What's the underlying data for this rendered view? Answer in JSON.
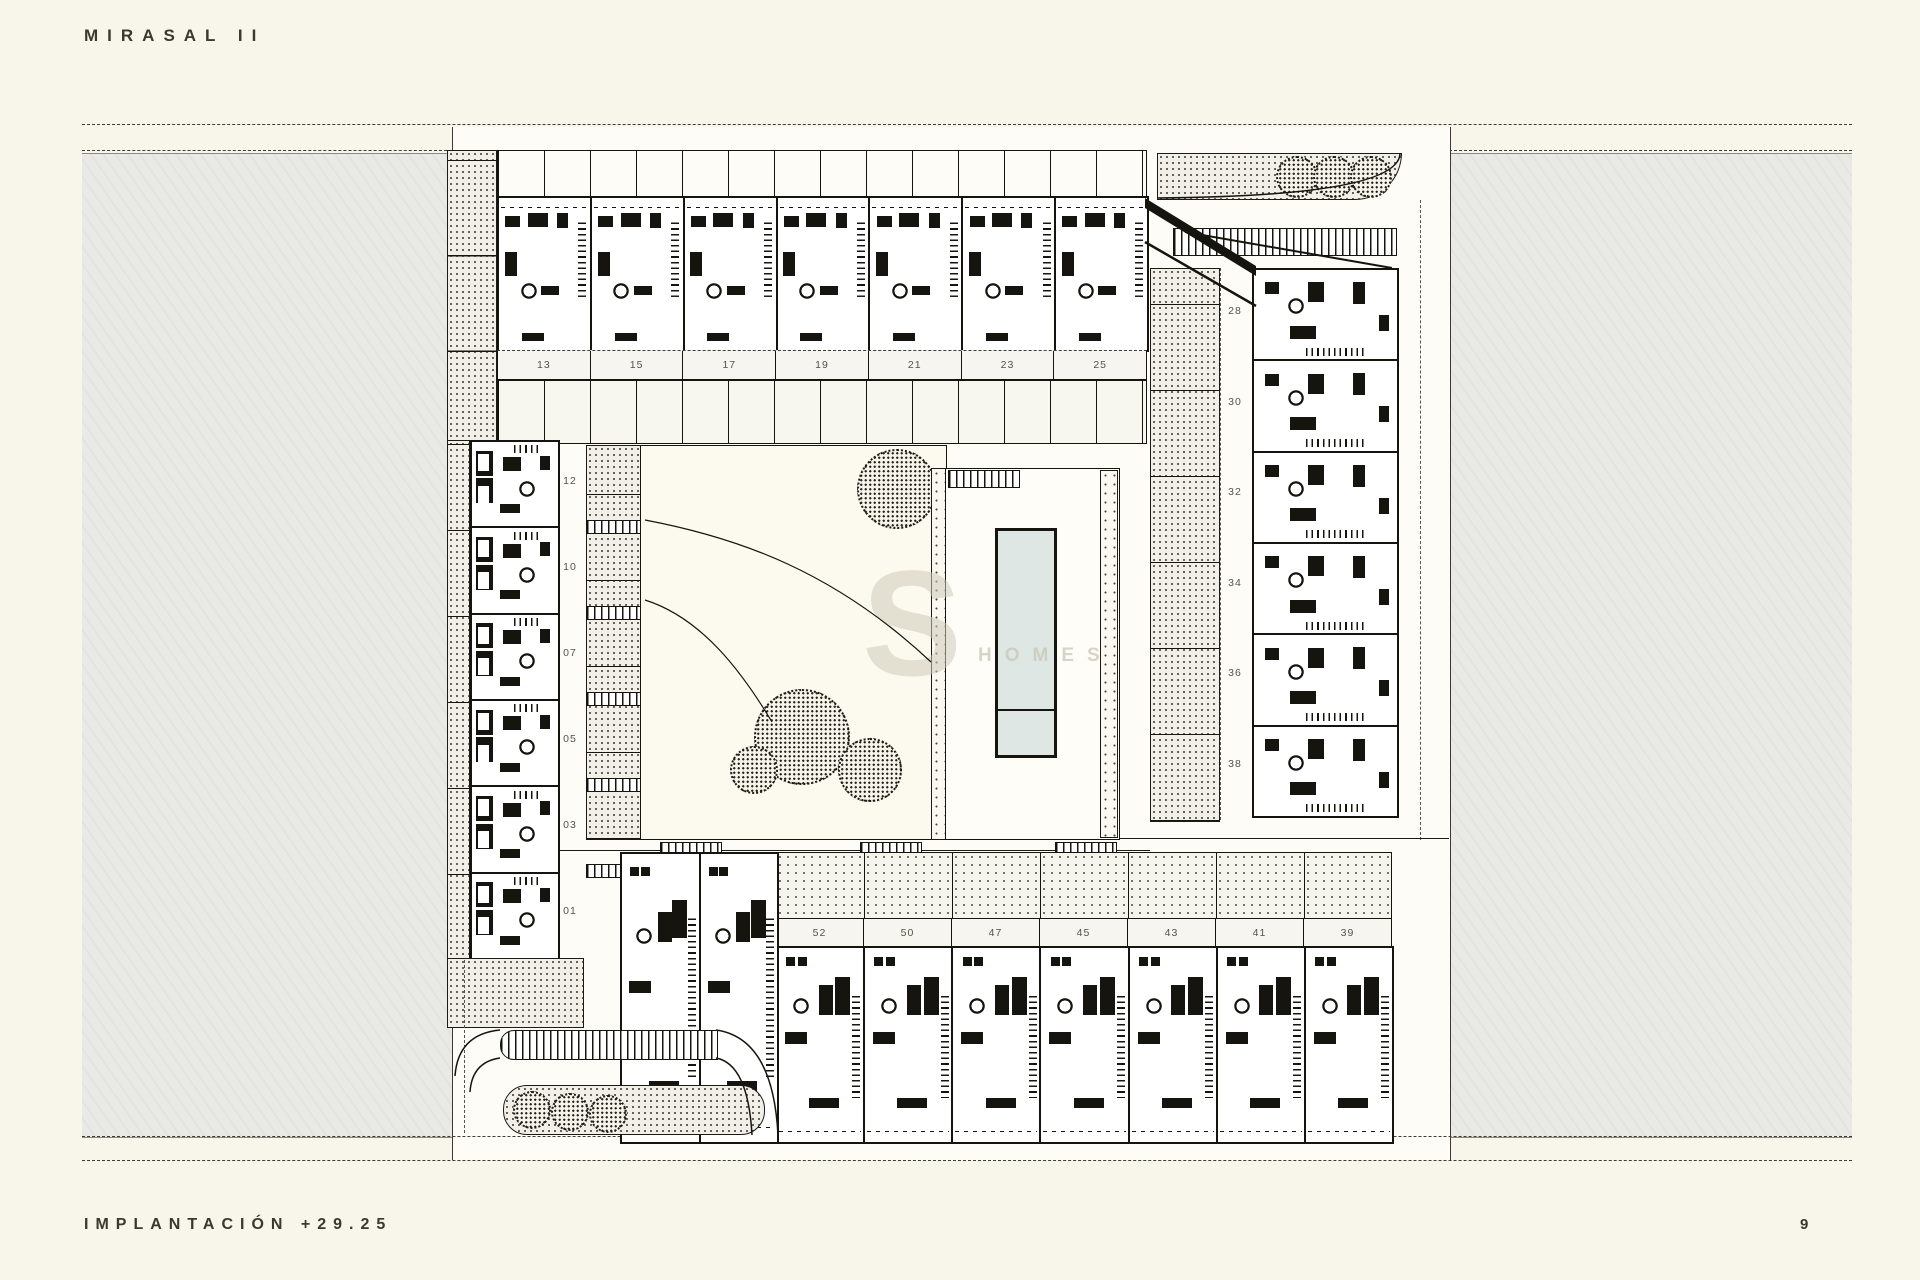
{
  "page": {
    "title": "MIRASAL II",
    "footer_label": "IMPLANTACIÓN +29.25",
    "page_number": "9"
  },
  "plan": {
    "top_row": {
      "units": [
        "13",
        "15",
        "17",
        "19",
        "21",
        "23",
        "25"
      ]
    },
    "right_column": {
      "units": [
        "28",
        "30",
        "32",
        "34",
        "36",
        "38"
      ]
    },
    "left_column": {
      "units": [
        "12",
        "10",
        "07",
        "05",
        "03",
        "01"
      ]
    },
    "bottom_row": {
      "units": [
        "52",
        "50",
        "47",
        "45",
        "43",
        "41",
        "39"
      ]
    },
    "watermark": {
      "letter": "S",
      "word": "HOMES"
    },
    "colors": {
      "paper": "#f8f5ea",
      "road_gray": "#e9e9e6",
      "plan_white": "#fdfcf6",
      "pool_water": "#dfe7e4",
      "ink": "#15140f"
    }
  }
}
